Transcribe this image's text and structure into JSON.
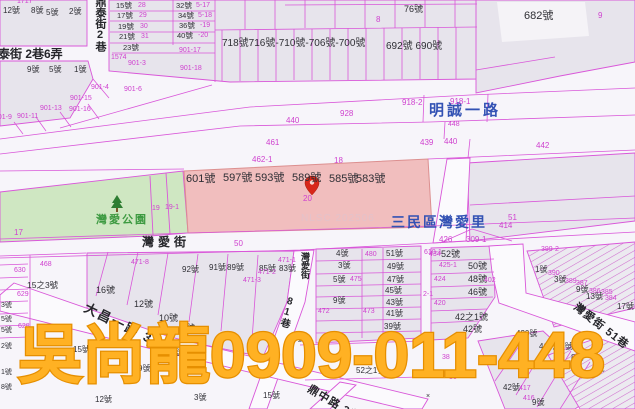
{
  "map": {
    "watermark_text": "吳尚龍0909-011-448",
    "nlsc_watermark_text": "NLSC 202506",
    "district_label": "三民區灣愛里",
    "park_name": "灣愛公園",
    "highlighted_lots": [
      "601號",
      "597號",
      "593號",
      "589號",
      "585號",
      "583號"
    ],
    "selected_parcel": "20",
    "colors": {
      "parcel_line": "#d957d9",
      "parcel_number": "#cf42cf",
      "house_number": "#2f2f35",
      "road_name_blue": "#3352b4",
      "park_green": "#3d9a41",
      "park_fill": "#cfe7c2",
      "block_fill": "#e7e4ec",
      "highlight_fill": "#f0b9b9",
      "watermark_orange": "#ffb123",
      "nlsc_pink": "#e3c2ca",
      "pin_red": "#d8271a"
    },
    "labels": [
      {
        "n": "street-dingtai-lane-label",
        "t": "鼎泰街 2巷6弄",
        "x": -14,
        "y": 48,
        "c": "st",
        "s": 12
      },
      {
        "n": "street-dingtai-lane2-vertical-label",
        "t": "鼎泰街2巷",
        "x": 94,
        "y": -4,
        "c": "st",
        "s": 11,
        "v": 1
      },
      {
        "n": "street-mingcheng-1st-rd-label",
        "t": "明誠一路",
        "x": 429,
        "y": 103,
        "c": "blue",
        "s": 15,
        "ls": 3
      },
      {
        "n": "district-sanmin-wanai-label",
        "t": "三民區灣愛里",
        "x": 391,
        "y": 215,
        "c": "blue",
        "s": 14,
        "ls": 2
      },
      {
        "n": "street-wanai-label",
        "t": "灣愛街",
        "x": 142,
        "y": 236,
        "c": "st",
        "s": 12,
        "ls": 4
      },
      {
        "n": "street-wanai-vertical-label",
        "t": "灣愛街",
        "x": 300,
        "y": 252,
        "c": "st",
        "s": 9,
        "v": 1
      },
      {
        "n": "street-dachang-1st-rd-label",
        "t": "大昌一路 39巷",
        "x": 88,
        "y": 301,
        "c": "st",
        "s": 13,
        "r": 26,
        "ls": 2
      },
      {
        "n": "street-dingzhong-rd-label",
        "t": "鼎中路 3巷",
        "x": 311,
        "y": 384,
        "c": "st",
        "s": 11,
        "r": 31,
        "ls": 1
      },
      {
        "n": "street-lane81-label",
        "t": "81巷",
        "x": 286,
        "y": 295,
        "c": "st",
        "s": 10,
        "v": 1,
        "r": 16
      },
      {
        "n": "street-wanai-lane51-label",
        "t": "灣愛街 51巷",
        "x": 578,
        "y": 302,
        "c": "st",
        "s": 11,
        "r": 38,
        "ls": 1
      },
      {
        "n": "park-wanai-label",
        "t": "灣愛公園",
        "x": 96,
        "y": 215,
        "c": "green",
        "s": 11,
        "ls": 2
      },
      {
        "n": "nlsc-watermark",
        "t": "NLSC 202506",
        "x": 301,
        "y": 214,
        "c": "wm",
        "s": 10
      },
      {
        "n": "lot-601",
        "t": "601號",
        "x": 186,
        "y": 174,
        "c": "h",
        "s": 11
      },
      {
        "n": "lot-597",
        "t": "597號",
        "x": 223,
        "y": 173,
        "c": "h",
        "s": 11
      },
      {
        "n": "lot-593",
        "t": "593號",
        "x": 255,
        "y": 173,
        "c": "h",
        "s": 11
      },
      {
        "n": "lot-589",
        "t": "589號",
        "x": 292,
        "y": 173,
        "c": "h",
        "s": 11
      },
      {
        "n": "lot-585",
        "t": "585號",
        "x": 329,
        "y": 174,
        "c": "h",
        "s": 11
      },
      {
        "n": "lot-583",
        "t": "583號",
        "x": 356,
        "y": 174,
        "c": "h",
        "s": 11
      },
      {
        "n": "selected-parcel-number",
        "t": "20",
        "x": 303,
        "y": 195,
        "c": "m",
        "s": 8
      },
      {
        "t": "1717",
        "x": 17,
        "y": -2,
        "c": "m",
        "s": 7
      },
      {
        "t": "12號",
        "x": 3,
        "y": 7,
        "c": "h"
      },
      {
        "t": "8號",
        "x": 31,
        "y": 7,
        "c": "h"
      },
      {
        "t": "5號",
        "x": 46,
        "y": 9,
        "c": "h"
      },
      {
        "t": "2號",
        "x": 69,
        "y": 8,
        "c": "h"
      },
      {
        "t": "9號",
        "x": 27,
        "y": 66,
        "c": "h"
      },
      {
        "t": "5號",
        "x": 49,
        "y": 66,
        "c": "h"
      },
      {
        "t": "1號",
        "x": 74,
        "y": 66,
        "c": "h"
      },
      {
        "t": "15號",
        "x": 116,
        "y": 2,
        "c": "h",
        "s": 7.5
      },
      {
        "t": "28",
        "x": 138,
        "y": 2,
        "c": "m",
        "s": 7
      },
      {
        "t": "17號",
        "x": 117,
        "y": 12,
        "c": "h",
        "s": 7.5
      },
      {
        "t": "29",
        "x": 139,
        "y": 12,
        "c": "m",
        "s": 7
      },
      {
        "t": "19號",
        "x": 118,
        "y": 23,
        "c": "h",
        "s": 7.5
      },
      {
        "t": "30",
        "x": 140,
        "y": 23,
        "c": "m",
        "s": 7
      },
      {
        "t": "21號",
        "x": 119,
        "y": 33,
        "c": "h",
        "s": 7.5
      },
      {
        "t": "31",
        "x": 141,
        "y": 33,
        "c": "m",
        "s": 7
      },
      {
        "t": "23號",
        "x": 123,
        "y": 44,
        "c": "h",
        "s": 7.5
      },
      {
        "t": "1574",
        "x": 111,
        "y": 54,
        "c": "m",
        "s": 7
      },
      {
        "t": "901-3",
        "x": 128,
        "y": 60,
        "c": "m",
        "s": 7
      },
      {
        "t": "32號",
        "x": 176,
        "y": 2,
        "c": "h",
        "s": 7.5
      },
      {
        "t": "5-17",
        "x": 196,
        "y": 2,
        "c": "m",
        "s": 7
      },
      {
        "t": "34號",
        "x": 178,
        "y": 12,
        "c": "h",
        "s": 7.5
      },
      {
        "t": "5-18",
        "x": 198,
        "y": 12,
        "c": "m",
        "s": 7
      },
      {
        "t": "36號",
        "x": 179,
        "y": 22,
        "c": "h",
        "s": 7.5
      },
      {
        "t": "-19",
        "x": 200,
        "y": 22,
        "c": "m",
        "s": 7
      },
      {
        "t": "40號",
        "x": 177,
        "y": 32,
        "c": "h",
        "s": 7.5
      },
      {
        "t": "-20",
        "x": 198,
        "y": 32,
        "c": "m",
        "s": 7
      },
      {
        "t": "901-17",
        "x": 179,
        "y": 47,
        "c": "m",
        "s": 7
      },
      {
        "t": "901-18",
        "x": 180,
        "y": 65,
        "c": "m",
        "s": 7
      },
      {
        "t": "901-4",
        "x": 91,
        "y": 84,
        "c": "m",
        "s": 7
      },
      {
        "t": "901-15",
        "x": 70,
        "y": 95,
        "c": "m",
        "s": 7
      },
      {
        "t": "901-13",
        "x": 40,
        "y": 105,
        "c": "m",
        "s": 7
      },
      {
        "t": "901-16",
        "x": 69,
        "y": 106,
        "c": "m",
        "s": 7
      },
      {
        "t": "901-11",
        "x": 17,
        "y": 113,
        "c": "m",
        "s": 7
      },
      {
        "t": "901-9",
        "x": -6,
        "y": 114,
        "c": "m",
        "s": 7
      },
      {
        "t": "901-6",
        "x": 124,
        "y": 86,
        "c": "m",
        "s": 7
      },
      {
        "t": "718號716號-710號-706號-700號",
        "x": 222,
        "y": 39,
        "c": "h",
        "s": 10
      },
      {
        "t": "692號 690號",
        "x": 386,
        "y": 42,
        "c": "h",
        "s": 10
      },
      {
        "t": "76號",
        "x": 404,
        "y": 5,
        "c": "h",
        "s": 9
      },
      {
        "t": "8",
        "x": 376,
        "y": 16,
        "c": "m"
      },
      {
        "t": "682號",
        "x": 524,
        "y": 11,
        "c": "h",
        "s": 11
      },
      {
        "t": "9",
        "x": 598,
        "y": 12,
        "c": "m"
      },
      {
        "t": "928",
        "x": 340,
        "y": 110,
        "c": "m"
      },
      {
        "t": "918-2",
        "x": 402,
        "y": 99,
        "c": "m"
      },
      {
        "t": "918-1",
        "x": 450,
        "y": 98,
        "c": "m"
      },
      {
        "t": "448",
        "x": 448,
        "y": 121,
        "c": "m",
        "s": 7
      },
      {
        "t": "440",
        "x": 286,
        "y": 117,
        "c": "m"
      },
      {
        "t": "439",
        "x": 420,
        "y": 139,
        "c": "m"
      },
      {
        "t": "440",
        "x": 444,
        "y": 138,
        "c": "m"
      },
      {
        "t": "442",
        "x": 536,
        "y": 142,
        "c": "m"
      },
      {
        "t": "461",
        "x": 266,
        "y": 139,
        "c": "m"
      },
      {
        "t": "462-1",
        "x": 252,
        "y": 156,
        "c": "m"
      },
      {
        "t": "18",
        "x": 334,
        "y": 157,
        "c": "m"
      },
      {
        "t": "17",
        "x": 14,
        "y": 229,
        "c": "m"
      },
      {
        "t": "19",
        "x": 152,
        "y": 205,
        "c": "m",
        "s": 7
      },
      {
        "t": "19-1",
        "x": 165,
        "y": 204,
        "c": "m",
        "s": 7
      },
      {
        "t": "51",
        "x": 508,
        "y": 214,
        "c": "m"
      },
      {
        "t": "414",
        "x": 499,
        "y": 222,
        "c": "m"
      },
      {
        "t": "426",
        "x": 439,
        "y": 236,
        "c": "m"
      },
      {
        "t": "309-1",
        "x": 466,
        "y": 236,
        "c": "m"
      },
      {
        "t": "399-2",
        "x": 541,
        "y": 246,
        "c": "m",
        "s": 7
      },
      {
        "t": "610-1",
        "x": 424,
        "y": 249,
        "c": "m",
        "s": 7
      },
      {
        "t": "50",
        "x": 234,
        "y": 240,
        "c": "m"
      },
      {
        "t": "468",
        "x": 40,
        "y": 261,
        "c": "m",
        "s": 7
      },
      {
        "t": "471-8",
        "x": 131,
        "y": 259,
        "c": "m",
        "s": 7
      },
      {
        "t": "630",
        "x": 14,
        "y": 267,
        "c": "m",
        "s": 7
      },
      {
        "t": "629",
        "x": 17,
        "y": 291,
        "c": "m",
        "s": 7
      },
      {
        "t": "628",
        "x": 18,
        "y": 323,
        "c": "m",
        "s": 7
      },
      {
        "t": "15之3號",
        "x": 27,
        "y": 281,
        "c": "h",
        "s": 8.5
      },
      {
        "t": "16號",
        "x": 96,
        "y": 286,
        "c": "h",
        "s": 9
      },
      {
        "t": "12號",
        "x": 134,
        "y": 300,
        "c": "h",
        "s": 9
      },
      {
        "t": "10號",
        "x": 159,
        "y": 314,
        "c": "h",
        "s": 9
      },
      {
        "t": "8號",
        "x": 181,
        "y": 324,
        "c": "h",
        "s": 9
      },
      {
        "t": "92號",
        "x": 182,
        "y": 266,
        "c": "h"
      },
      {
        "t": "91號",
        "x": 209,
        "y": 264,
        "c": "h"
      },
      {
        "t": "89號",
        "x": 227,
        "y": 264,
        "c": "h"
      },
      {
        "t": "85號",
        "x": 259,
        "y": 265,
        "c": "h"
      },
      {
        "t": "83號",
        "x": 279,
        "y": 265,
        "c": "h"
      },
      {
        "t": "471-3",
        "x": 243,
        "y": 277,
        "c": "m",
        "s": 7
      },
      {
        "t": "471-2",
        "x": 258,
        "y": 269,
        "c": "m",
        "s": 7
      },
      {
        "t": "471-1",
        "x": 278,
        "y": 257,
        "c": "m",
        "s": 7
      },
      {
        "t": "4號",
        "x": 336,
        "y": 250,
        "c": "h"
      },
      {
        "t": "480",
        "x": 365,
        "y": 251,
        "c": "m",
        "s": 7
      },
      {
        "t": "51號",
        "x": 386,
        "y": 250,
        "c": "h"
      },
      {
        "t": "3號",
        "x": 338,
        "y": 262,
        "c": "h"
      },
      {
        "t": "49號",
        "x": 387,
        "y": 263,
        "c": "h"
      },
      {
        "t": "5號",
        "x": 333,
        "y": 276,
        "c": "h"
      },
      {
        "t": "475",
        "x": 350,
        "y": 276,
        "c": "m",
        "s": 7
      },
      {
        "t": "47號",
        "x": 387,
        "y": 276,
        "c": "h"
      },
      {
        "t": "45號",
        "x": 385,
        "y": 287,
        "c": "h"
      },
      {
        "t": "9號",
        "x": 333,
        "y": 297,
        "c": "h"
      },
      {
        "t": "43號",
        "x": 386,
        "y": 299,
        "c": "h"
      },
      {
        "t": "472",
        "x": 318,
        "y": 308,
        "c": "m",
        "s": 7
      },
      {
        "t": "473",
        "x": 363,
        "y": 308,
        "c": "m",
        "s": 7
      },
      {
        "t": "41號",
        "x": 386,
        "y": 310,
        "c": "h"
      },
      {
        "t": "39號",
        "x": 384,
        "y": 323,
        "c": "h"
      },
      {
        "t": "434",
        "x": 429,
        "y": 251,
        "c": "m",
        "s": 7
      },
      {
        "t": "52號",
        "x": 441,
        "y": 250,
        "c": "h",
        "s": 9
      },
      {
        "t": "425-1",
        "x": 439,
        "y": 262,
        "c": "m",
        "s": 7
      },
      {
        "t": "50號",
        "x": 468,
        "y": 262,
        "c": "h",
        "s": 9
      },
      {
        "t": "424",
        "x": 434,
        "y": 276,
        "c": "m",
        "s": 7
      },
      {
        "t": "48號",
        "x": 468,
        "y": 275,
        "c": "h",
        "s": 9
      },
      {
        "t": "402",
        "x": 484,
        "y": 277,
        "c": "m",
        "s": 7
      },
      {
        "t": "46號",
        "x": 468,
        "y": 288,
        "c": "h",
        "s": 9
      },
      {
        "t": "420",
        "x": 434,
        "y": 300,
        "c": "m",
        "s": 7
      },
      {
        "t": "2-1",
        "x": 423,
        "y": 291,
        "c": "m",
        "s": 7
      },
      {
        "t": "42之1號",
        "x": 455,
        "y": 313,
        "c": "h",
        "s": 9
      },
      {
        "t": "42號",
        "x": 463,
        "y": 325,
        "c": "h",
        "s": 9
      },
      {
        "t": "1號",
        "x": 535,
        "y": 266,
        "c": "h"
      },
      {
        "t": "390",
        "x": 548,
        "y": 270,
        "c": "m",
        "s": 7
      },
      {
        "t": "3號",
        "x": 554,
        "y": 276,
        "c": "h"
      },
      {
        "t": "389",
        "x": 565,
        "y": 278,
        "c": "m",
        "s": 7
      },
      {
        "t": "387",
        "x": 576,
        "y": 280,
        "c": "m",
        "s": 7
      },
      {
        "t": "9號",
        "x": 576,
        "y": 286,
        "c": "h"
      },
      {
        "t": "386",
        "x": 589,
        "y": 288,
        "c": "m",
        "s": 7
      },
      {
        "t": "385",
        "x": 601,
        "y": 289,
        "c": "m",
        "s": 7
      },
      {
        "t": "13號",
        "x": 586,
        "y": 293,
        "c": "h"
      },
      {
        "t": "384",
        "x": 605,
        "y": 295,
        "c": "m",
        "s": 7
      },
      {
        "t": "17號",
        "x": 617,
        "y": 303,
        "c": "h"
      },
      {
        "t": "430號",
        "x": 516,
        "y": 330,
        "c": "h"
      },
      {
        "t": "418之4號",
        "x": 539,
        "y": 343,
        "c": "h"
      },
      {
        "t": "8號",
        "x": 571,
        "y": 354,
        "c": "h"
      },
      {
        "t": "4號",
        "x": 592,
        "y": 365,
        "c": "h"
      },
      {
        "t": "42號",
        "x": 503,
        "y": 384,
        "c": "h"
      },
      {
        "t": "417",
        "x": 519,
        "y": 385,
        "c": "m",
        "s": 7
      },
      {
        "t": "416",
        "x": 523,
        "y": 395,
        "c": "m",
        "s": 7
      },
      {
        "t": "9號",
        "x": 532,
        "y": 399,
        "c": "h"
      },
      {
        "t": "36",
        "x": 449,
        "y": 374,
        "c": "m",
        "s": 7
      },
      {
        "t": "38",
        "x": 442,
        "y": 354,
        "c": "m",
        "s": 7
      },
      {
        "t": "×",
        "x": 426,
        "y": 393,
        "c": "h",
        "s": 7
      },
      {
        "t": "15號",
        "x": 73,
        "y": 346,
        "c": "h"
      },
      {
        "t": "4號",
        "x": 146,
        "y": 341,
        "c": "h"
      },
      {
        "t": "2號",
        "x": 171,
        "y": 349,
        "c": "h"
      },
      {
        "t": "9號",
        "x": 138,
        "y": 365,
        "c": "h"
      },
      {
        "t": "3號",
        "x": 194,
        "y": 394,
        "c": "h"
      },
      {
        "t": "12號",
        "x": 95,
        "y": 396,
        "c": "h"
      },
      {
        "t": "16號",
        "x": 288,
        "y": 335,
        "c": "h"
      },
      {
        "t": "15號",
        "x": 263,
        "y": 392,
        "c": "h"
      },
      {
        "t": "52之1號",
        "x": 356,
        "y": 367,
        "c": "h"
      },
      {
        "t": "3號",
        "x": 1,
        "y": 302,
        "c": "h",
        "s": 7
      },
      {
        "t": "5號",
        "x": 1,
        "y": 316,
        "c": "h",
        "s": 7
      },
      {
        "t": "5號",
        "x": 1,
        "y": 327,
        "c": "h",
        "s": 7
      },
      {
        "t": "2號",
        "x": 1,
        "y": 343,
        "c": "h",
        "s": 7
      },
      {
        "t": "1號",
        "x": 1,
        "y": 369,
        "c": "h",
        "s": 7
      },
      {
        "t": "8號",
        "x": 1,
        "y": 384,
        "c": "h",
        "s": 7
      }
    ]
  }
}
